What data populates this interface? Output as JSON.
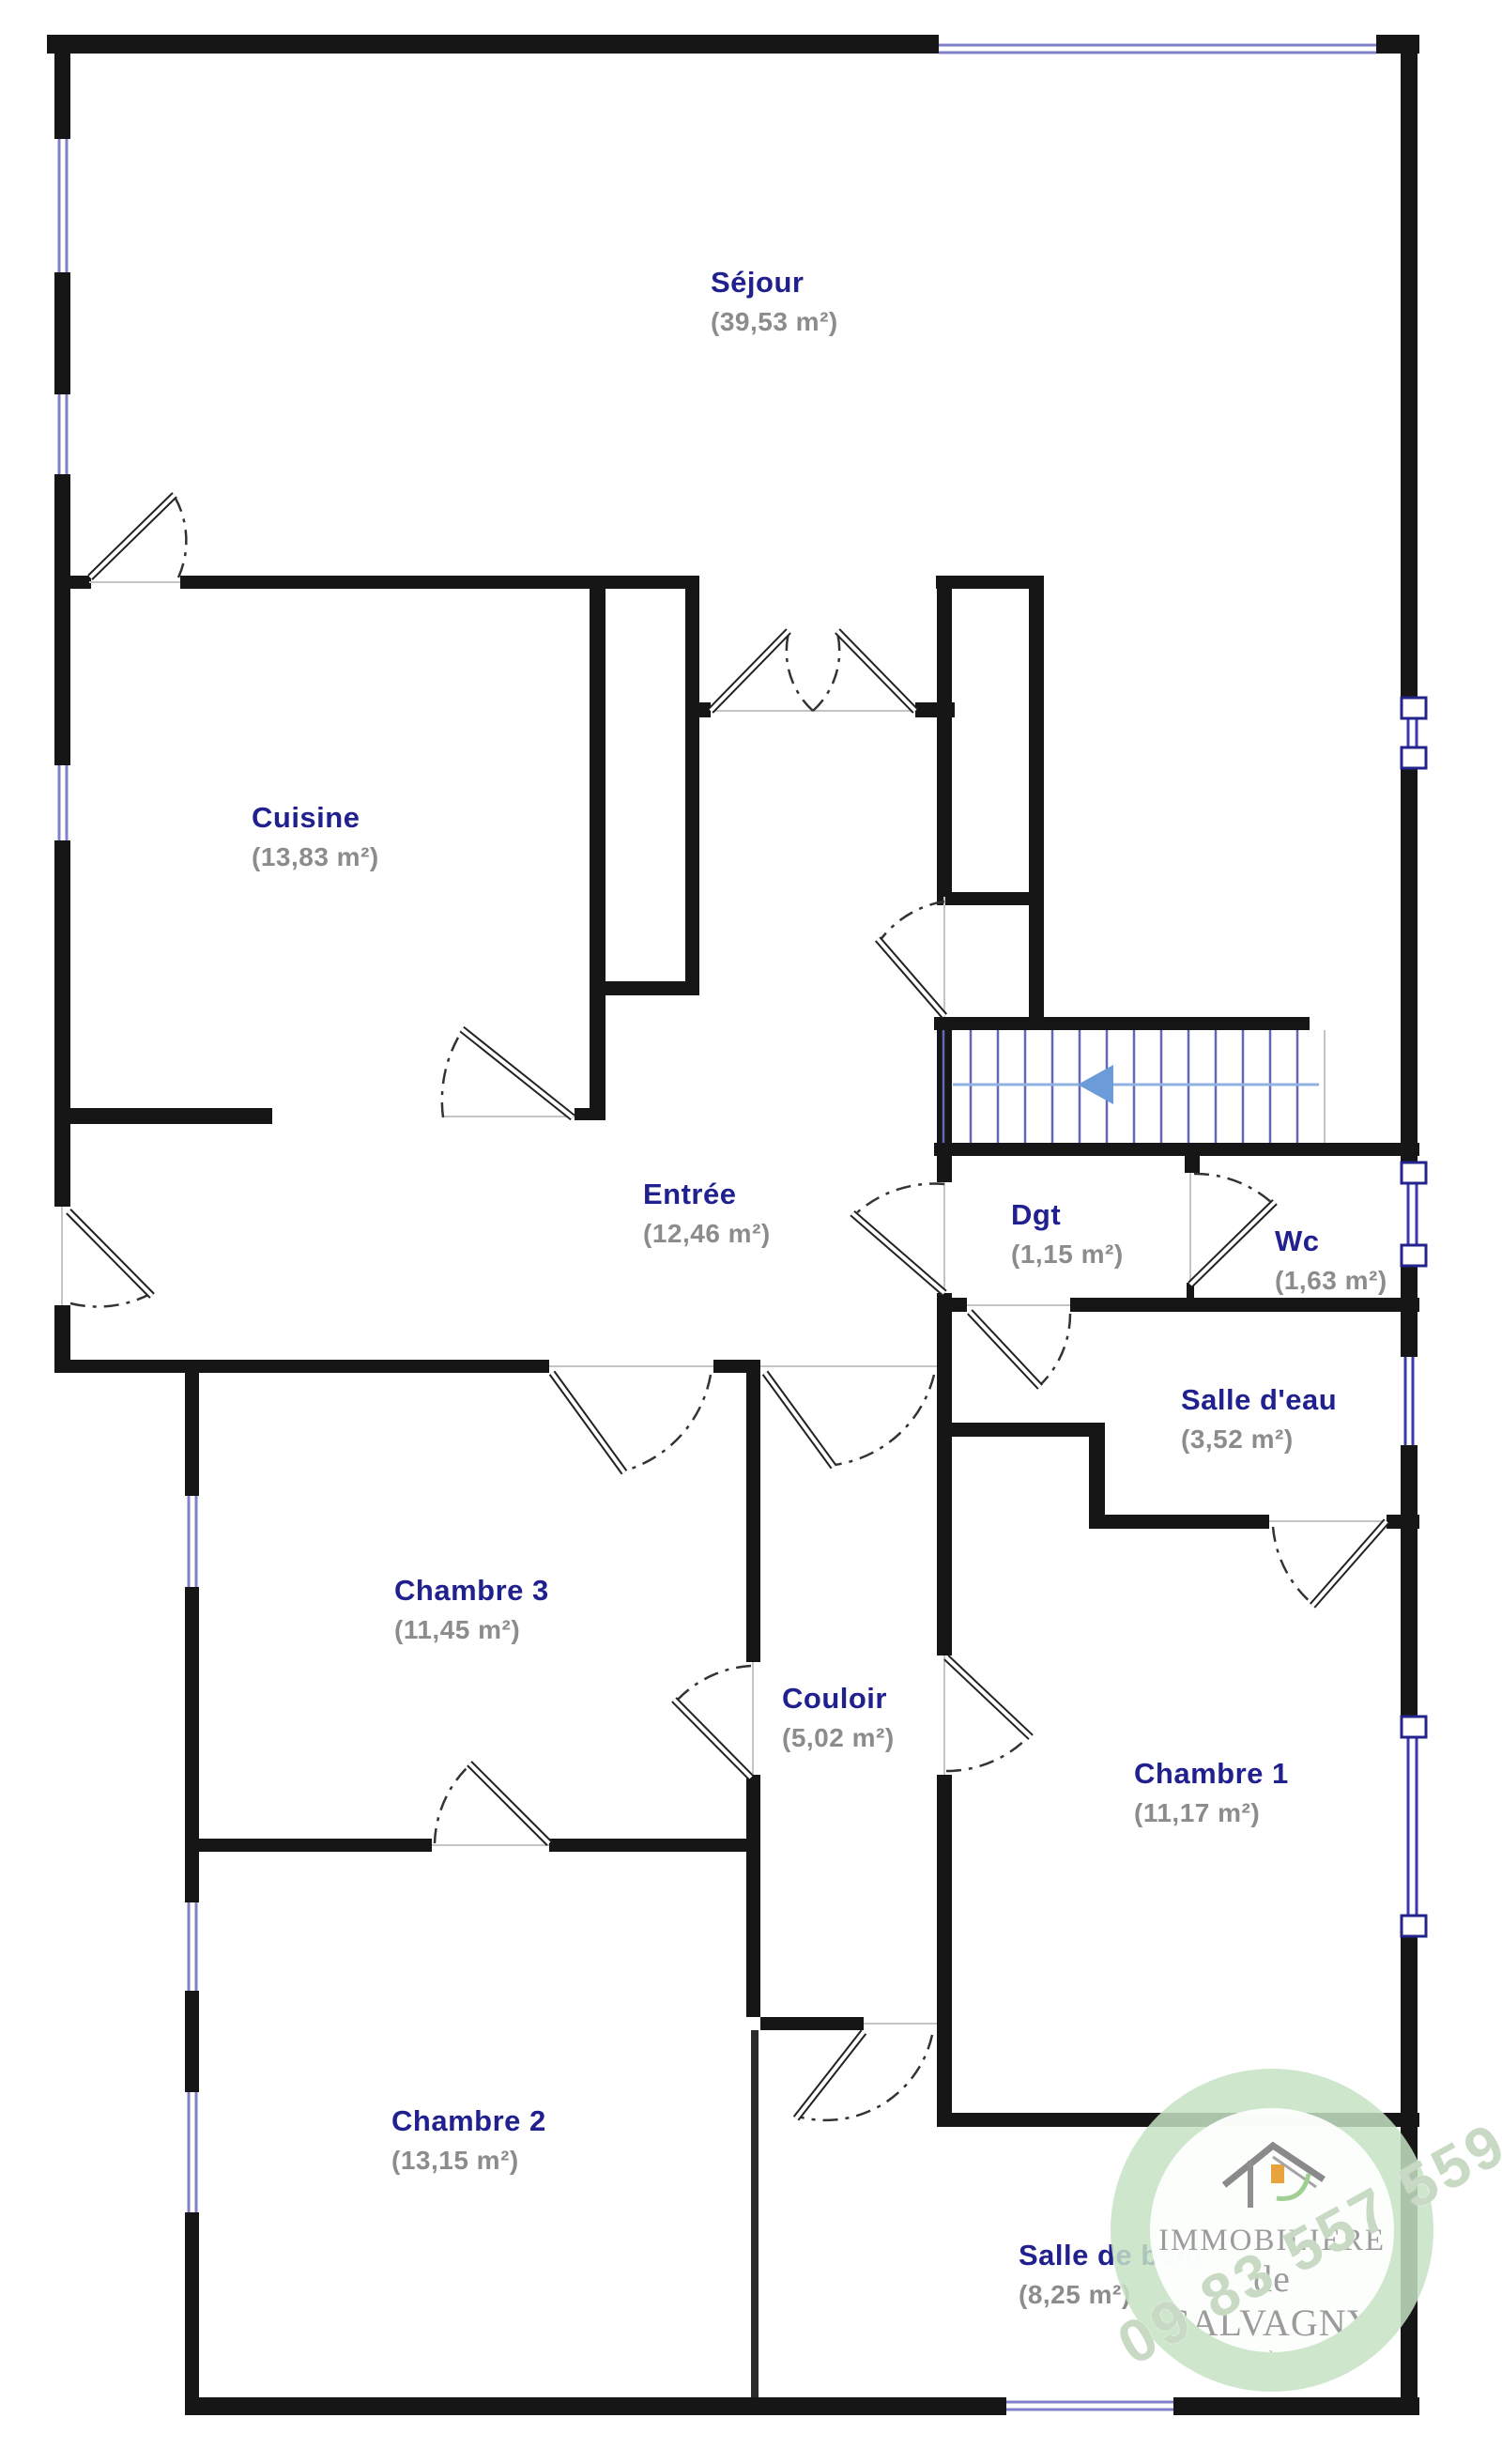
{
  "plan": {
    "rooms": [
      {
        "name": "Séjour",
        "area": "(39,53 m²)"
      },
      {
        "name": "Cuisine",
        "area": "(13,83 m²)"
      },
      {
        "name": "Entrée",
        "area": "(12,46 m²)"
      },
      {
        "name": "Dgt",
        "area": "(1,15 m²)"
      },
      {
        "name": "Wc",
        "area": "(1,63 m²)"
      },
      {
        "name": "Salle d'eau",
        "area": "(3,52 m²)"
      },
      {
        "name": "Chambre 3",
        "area": "(11,45 m²)"
      },
      {
        "name": "Couloir",
        "area": "(5,02 m²)"
      },
      {
        "name": "Chambre 1",
        "area": "(11,17 m²)"
      },
      {
        "name": "Chambre 2",
        "area": "(13,15 m²)"
      },
      {
        "name": "Salle de bain",
        "area": "(8,25 m²)"
      }
    ],
    "colors": {
      "wall": "#161616",
      "room_name": "#20208f",
      "room_area": "#8c8c8c",
      "window": "#8080c8",
      "window_dark": "#3a3ab0",
      "stair_tread": "#6666b2",
      "stair_arrow": "#6b9bd8",
      "logo_green": "#c5e2c3"
    }
  },
  "logo": {
    "line1": "IMMOBILIERE",
    "line2": "de SALVAGNY",
    "tagline": "Partenaire de vos projets",
    "phone": "09 83 557 559"
  }
}
